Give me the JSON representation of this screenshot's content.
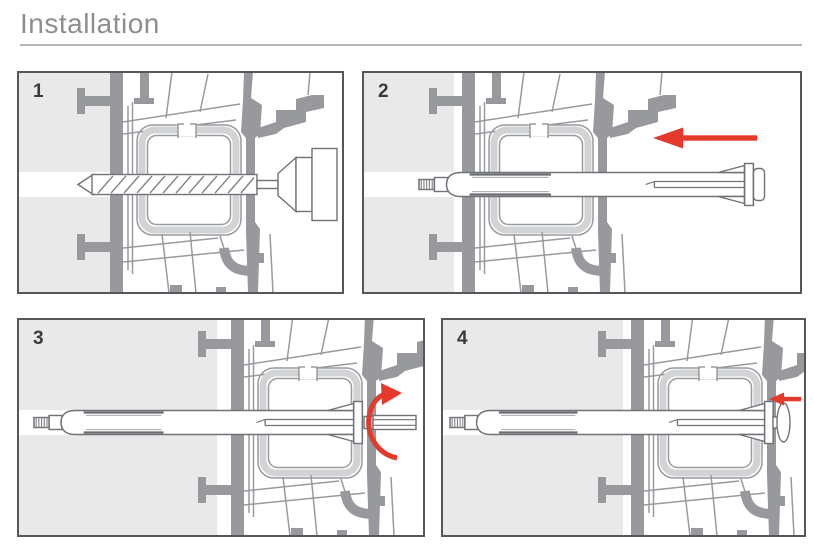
{
  "page": {
    "title": "Installation"
  },
  "colors": {
    "accent_red": "#e33a2c",
    "profile_gray": "#97999c",
    "wall_gray": "#e9e9ea",
    "outline_gray": "#6f7276",
    "border_gray": "#55575b",
    "title_gray": "#8c8e91",
    "number_gray": "#3b3b3d",
    "rule_gray": "#b6b6b8"
  },
  "steps": [
    {
      "number": "1",
      "illustration": "drill-bit-drilling-through-frame-into-wall"
    },
    {
      "number": "2",
      "illustration": "frame-anchor-being-inserted",
      "arrow": "push-in-left"
    },
    {
      "number": "3",
      "illustration": "screw-being-tightened-with-driver",
      "arrow": "rotate-clockwise"
    },
    {
      "number": "4",
      "illustration": "finished-flush-installation",
      "arrow": "flush-against-frame"
    }
  ]
}
